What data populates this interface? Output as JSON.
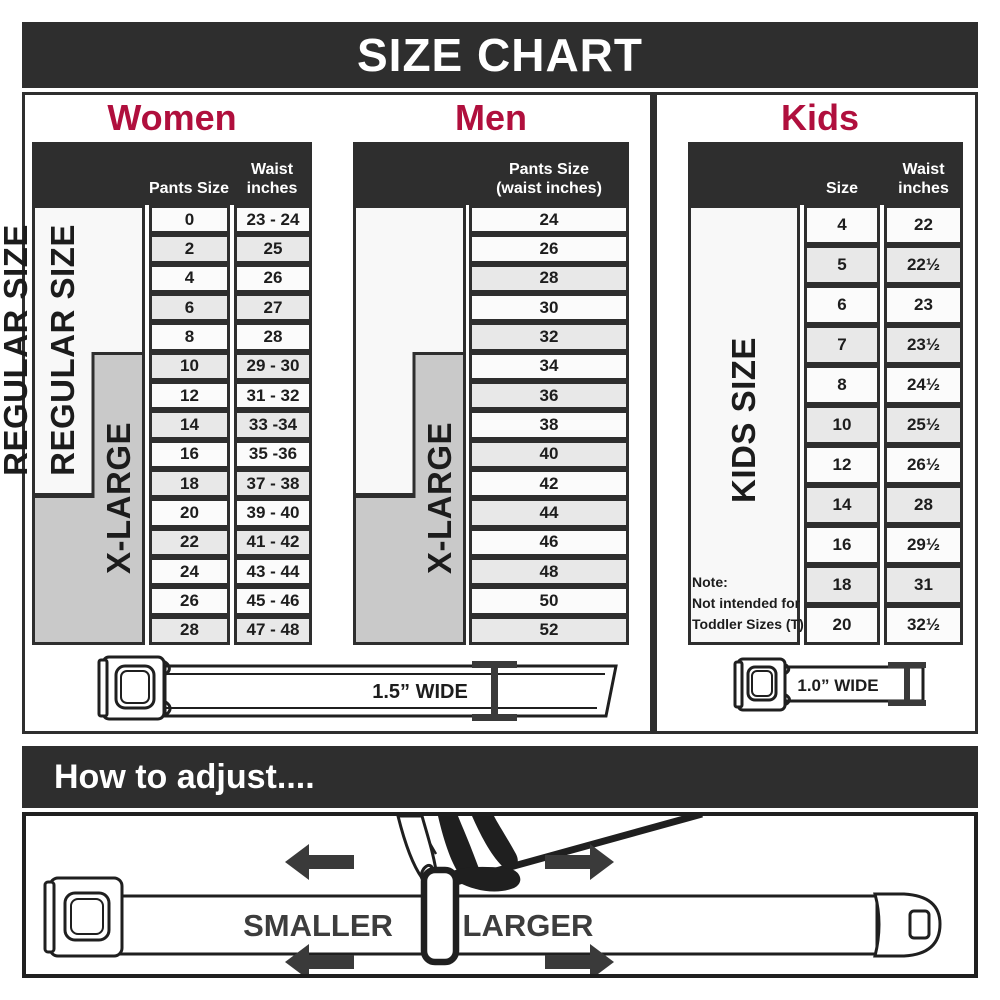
{
  "colors": {
    "dark": "#2e2e2e",
    "accent": "#b00f3d",
    "gray_fill": "#c9c9c9",
    "row_shade": "#e8e8e8",
    "row_bg": "#fbfbfb",
    "ink": "#1d1d1d",
    "arrow": "#3a3a3a"
  },
  "title": "SIZE CHART",
  "sections": {
    "women": {
      "title": "Women",
      "col1_header": "Pants Size",
      "col2_header_lines": [
        "Waist",
        "inches"
      ],
      "regular_label": "REGULAR SIZE",
      "xlarge_label": "X-LARGE",
      "rows": [
        {
          "size": "0",
          "waist": "23 - 24",
          "shaded": false
        },
        {
          "size": "2",
          "waist": "25",
          "shaded": true
        },
        {
          "size": "4",
          "waist": "26",
          "shaded": false
        },
        {
          "size": "6",
          "waist": "27",
          "shaded": true
        },
        {
          "size": "8",
          "waist": "28",
          "shaded": false
        },
        {
          "size": "10",
          "waist": "29 - 30",
          "shaded": true
        },
        {
          "size": "12",
          "waist": "31 - 32",
          "shaded": false
        },
        {
          "size": "14",
          "waist": "33 -34",
          "shaded": true
        },
        {
          "size": "16",
          "waist": "35 -36",
          "shaded": false
        },
        {
          "size": "18",
          "waist": "37 - 38",
          "shaded": true
        },
        {
          "size": "20",
          "waist": "39 - 40",
          "shaded": false
        },
        {
          "size": "22",
          "waist": "41 - 42",
          "shaded": true
        },
        {
          "size": "24",
          "waist": "43 - 44",
          "shaded": false
        },
        {
          "size": "26",
          "waist": "45 - 46",
          "shaded": false
        },
        {
          "size": "28",
          "waist": "47 - 48",
          "shaded": true
        }
      ]
    },
    "men": {
      "title": "Men",
      "col_header_lines": [
        "Pants Size",
        "(waist inches)"
      ],
      "regular_label": "REGULAR SIZE",
      "xlarge_label": "X-LARGE",
      "rows": [
        {
          "size": "24",
          "shaded": false
        },
        {
          "size": "26",
          "shaded": false
        },
        {
          "size": "28",
          "shaded": true
        },
        {
          "size": "30",
          "shaded": false
        },
        {
          "size": "32",
          "shaded": true
        },
        {
          "size": "34",
          "shaded": false
        },
        {
          "size": "36",
          "shaded": true
        },
        {
          "size": "38",
          "shaded": false
        },
        {
          "size": "40",
          "shaded": true
        },
        {
          "size": "42",
          "shaded": false
        },
        {
          "size": "44",
          "shaded": true
        },
        {
          "size": "46",
          "shaded": false
        },
        {
          "size": "48",
          "shaded": true
        },
        {
          "size": "50",
          "shaded": false
        },
        {
          "size": "52",
          "shaded": true
        }
      ]
    },
    "kids": {
      "title": "Kids",
      "col1_header": "Size",
      "col2_header_lines": [
        "Waist",
        "inches"
      ],
      "side_label": "KIDS SIZE",
      "note_lines": [
        "Note:",
        "Not intended for",
        "Toddler Sizes (T)"
      ],
      "rows": [
        {
          "size": "4",
          "waist": "22",
          "shaded": false
        },
        {
          "size": "5",
          "waist": "22½",
          "shaded": true
        },
        {
          "size": "6",
          "waist": "23",
          "shaded": false
        },
        {
          "size": "7",
          "waist": "23½",
          "shaded": true
        },
        {
          "size": "8",
          "waist": "24½",
          "shaded": false
        },
        {
          "size": "10",
          "waist": "25½",
          "shaded": true
        },
        {
          "size": "12",
          "waist": "26½",
          "shaded": false
        },
        {
          "size": "14",
          "waist": "28",
          "shaded": true
        },
        {
          "size": "16",
          "waist": "29½",
          "shaded": false
        },
        {
          "size": "18",
          "waist": "31",
          "shaded": true
        },
        {
          "size": "20",
          "waist": "32½",
          "shaded": false
        }
      ]
    }
  },
  "belts": {
    "adult_width_label": "1.5” WIDE",
    "kids_width_label": "1.0” WIDE"
  },
  "adjust": {
    "header": "How to adjust....",
    "smaller": "SMALLER",
    "larger": "LARGER"
  }
}
